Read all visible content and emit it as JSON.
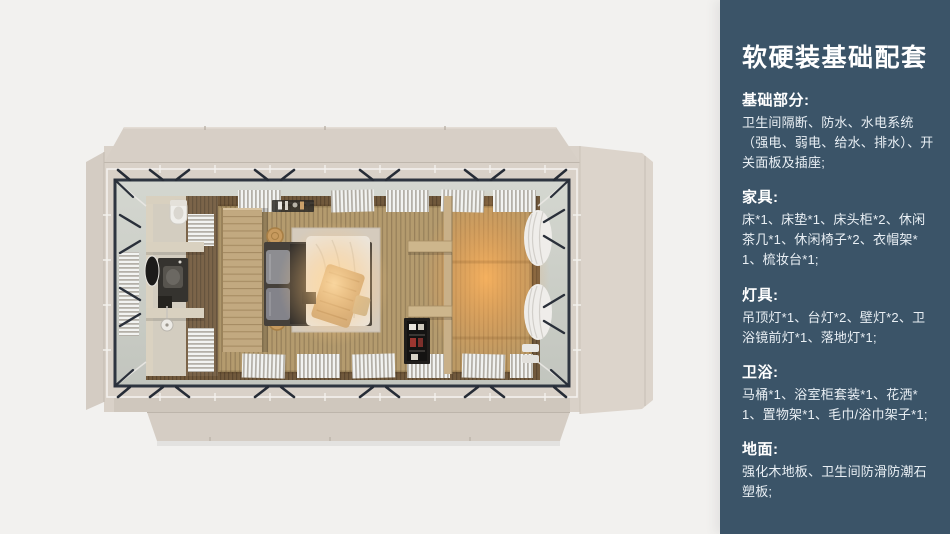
{
  "canvas": {
    "background": "#f2f1ef"
  },
  "panel": {
    "title": "软硬装基础配套",
    "colors": {
      "background": "#3b5468",
      "text": "#ffffff"
    },
    "sections": [
      {
        "heading": "基础部分:",
        "body": "卫生间隔断、防水、水电系统（强电、弱电、给水、排水）、开关面板及插座;"
      },
      {
        "heading": "家具:",
        "body": "床*1、床垫*1、床头柜*2、休闲茶几*1、休闲椅子*2、衣帽架*1、梳妆台*1;"
      },
      {
        "heading": "灯具:",
        "body": "吊顶灯*1、台灯*2、壁灯*2、卫浴镜前灯*1、落地灯*1;"
      },
      {
        "heading": "卫浴:",
        "body": "马桶*1、浴室柜套装*1、花洒*1、置物架*1、毛巾/浴巾架子*1;"
      },
      {
        "heading": "地面:",
        "body": "强化木地板、卫生间防滑防潮石塑板;"
      }
    ]
  },
  "floorplan_colors": {
    "shell_beige": "#d9d1c8",
    "steel_frame": "#2e3540",
    "floor_wood": "#b49b6e",
    "warm_glow": "#ffbe72",
    "gutter": "#ccd0c9"
  }
}
